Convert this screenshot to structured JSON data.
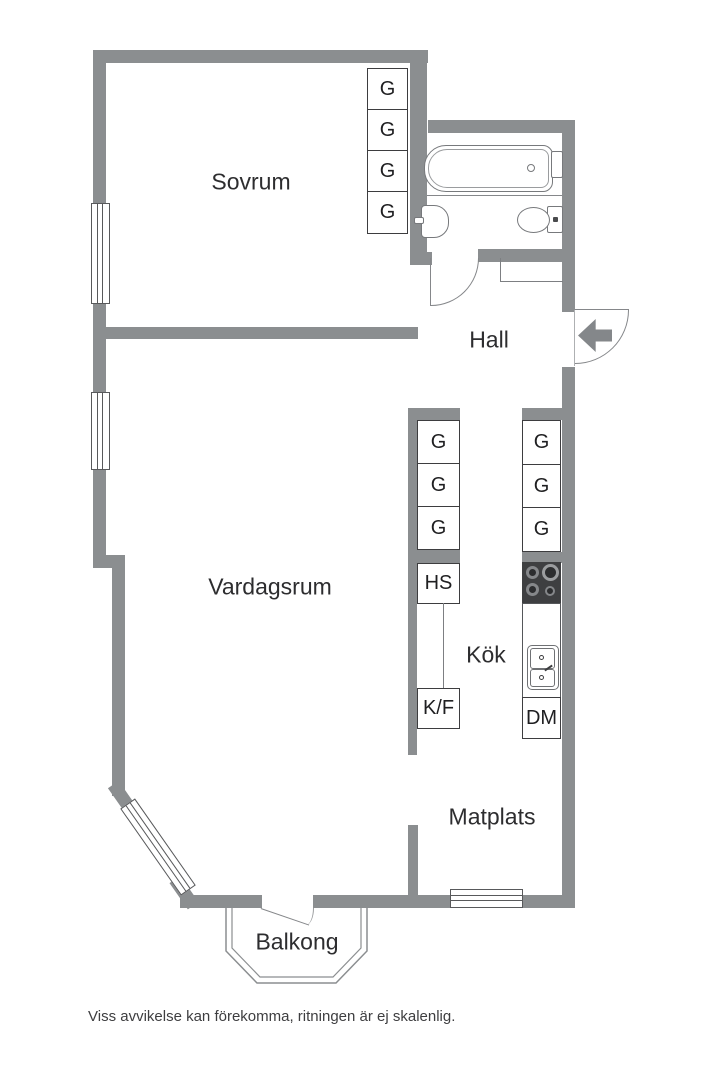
{
  "rooms": {
    "sovrum": "Sovrum",
    "hall": "Hall",
    "vardagsrum": "Vardagsrum",
    "kok": "Kök",
    "matplats": "Matplats",
    "balkong": "Balkong"
  },
  "bedroom_wardrobes": {
    "labels": [
      "G",
      "G",
      "G",
      "G"
    ]
  },
  "kitchen": {
    "left_run": [
      "G",
      "G",
      "G",
      "HS",
      "K/F"
    ],
    "right_run": [
      "G",
      "G",
      "G",
      "DM"
    ]
  },
  "footer": {
    "disclaimer": "Viss avvikelse kan förekomma, ritningen är ej skalenlig."
  },
  "colors": {
    "wall": "#8b8e90",
    "fixture_line": "#77797c",
    "cabinet_line": "#3d3d3f",
    "stove_body": "#3e3f41",
    "text": "#2d2d2f"
  }
}
